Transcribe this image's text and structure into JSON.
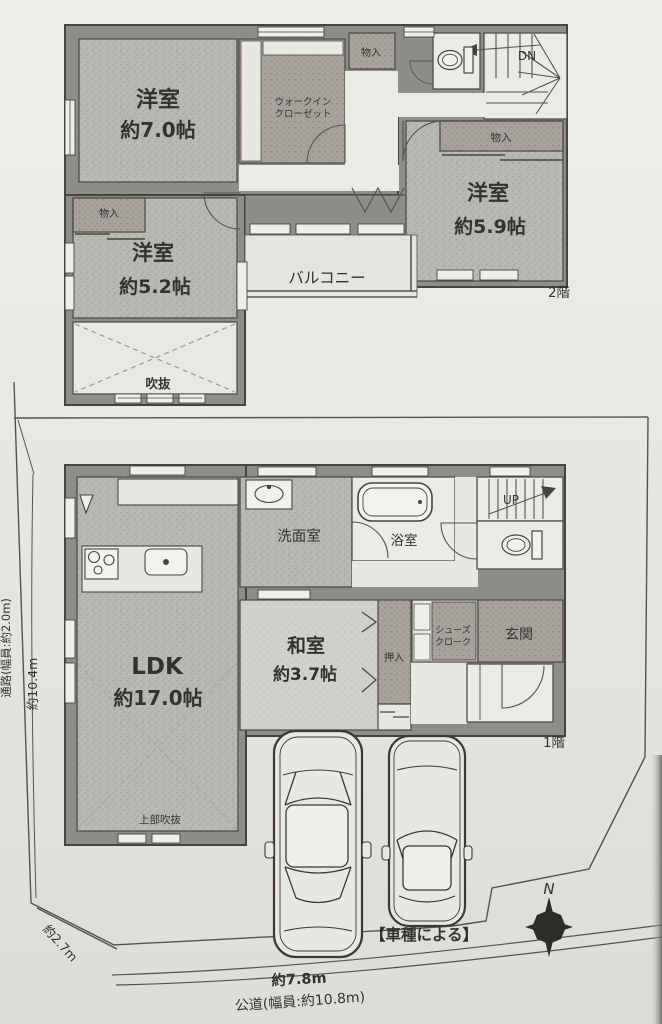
{
  "meta": {
    "title": "戸建て間取り図(1階・2階・配置図)",
    "colors": {
      "paper": "#e9e7e3",
      "wall": "#8f8d87",
      "room_fill": "#bab8b3",
      "dark_fill": "#a6a39d",
      "ink": "#33322e"
    }
  },
  "floor2": {
    "floor_label": "2階",
    "room_yoshitsu7_name": "洋室",
    "room_yoshitsu7_size": "約7.0帖",
    "wic_line1": "ウォークイン",
    "wic_line2": "クローゼット",
    "storage_top": "物入",
    "storage_right": "物入",
    "storage_left": "物入",
    "room_yoshitsu52_name": "洋室",
    "room_yoshitsu52_size": "約5.2帖",
    "room_yoshitsu59_name": "洋室",
    "room_yoshitsu59_size": "約5.9帖",
    "balcony": "バルコニー",
    "void_label": "吹抜",
    "stairs_down": "DN"
  },
  "floor1": {
    "floor_label": "1階",
    "ldk_name": "LDK",
    "ldk_size": "約17.0帖",
    "washroom": "洗面室",
    "bathroom": "浴室",
    "stairs_up": "UP",
    "washitsu_name": "和室",
    "washitsu_size": "約3.7帖",
    "oshiire": "押入",
    "shoes_line1": "シューズ",
    "shoes_line2": "クローク",
    "entrance": "玄関",
    "upper_void": "上部吹抜"
  },
  "site": {
    "car_note": "【車種による】",
    "compass_north": "N",
    "road_frontage": "約7.8m",
    "road_label": "公道(幅員:約10.8m)",
    "left_depth": "約10.4m",
    "corner_dim": "約2.7m",
    "passage_label": "通路(幅員:約2.0m)"
  }
}
